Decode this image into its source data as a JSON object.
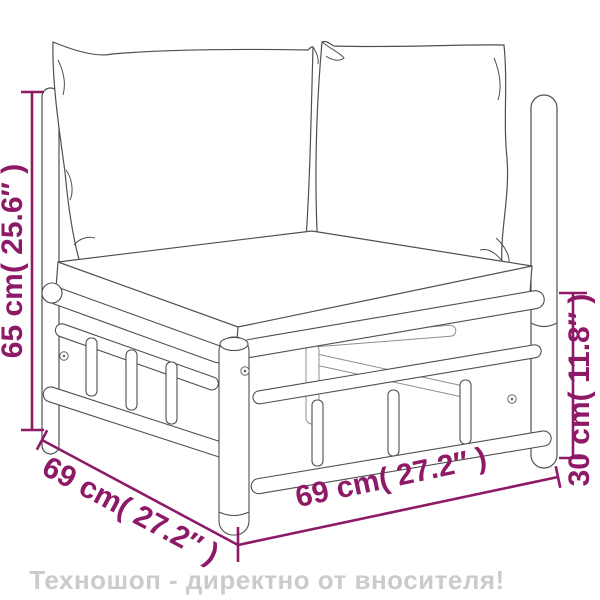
{
  "dimensions": {
    "left_height": "65 cm( 25.6″ )",
    "right_height": "30 cm( 11.8″ )",
    "bottom_left_depth": "69 cm( 27.2″ )",
    "bottom_right_width": "69 cm( 27.2″ )"
  },
  "banner": {
    "text": "Техношоп - директно от вносителя!"
  },
  "colors": {
    "dimension_accent": "#8e1a67",
    "drawing_outline": "#4f4f4f",
    "banner_text": "#cbcbcb",
    "background": "#ffffff"
  }
}
